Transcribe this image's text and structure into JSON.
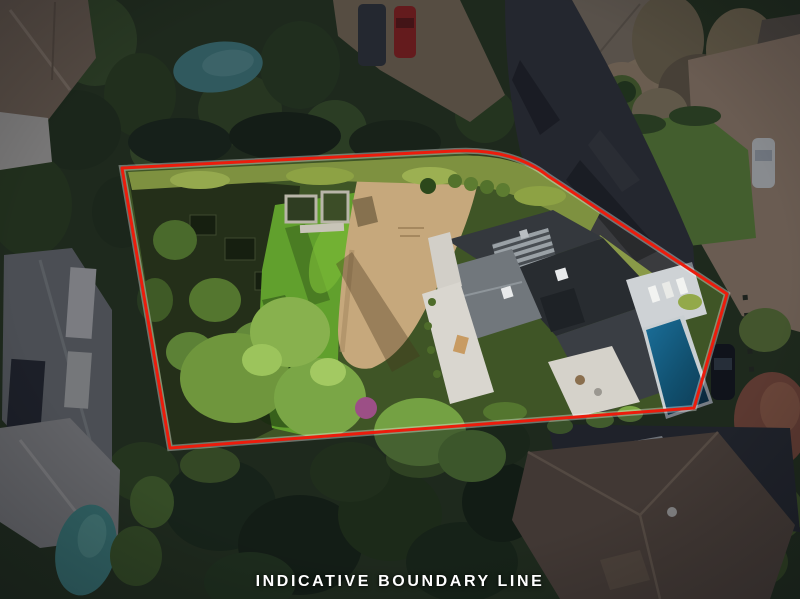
{
  "caption": {
    "text": "INDICATIVE BOUNDARY LINE",
    "color": "#ffffff"
  },
  "boundary": {
    "color": "#ec1c0c",
    "casing_color": "#ffffff"
  },
  "scene": {
    "type": "aerial-drone-photo",
    "features": [
      "subject-lot-boundary",
      "modern-house-dark-roof",
      "ribbed-roof-section",
      "white-decks",
      "swimming-pool",
      "pool-terrace",
      "lawn",
      "dead-grass-patch",
      "asphalt-driveway",
      "garden-terraces",
      "raised-planter-beds",
      "hedge-row",
      "neighbor-house-top",
      "neighbor-house-right-roof",
      "neighbor-house-bottom-right",
      "neighbor-house-left",
      "neighbor-house-bottom-left",
      "neighbor-pool-top-left",
      "neighbor-pool-bottom-left",
      "red-car",
      "dark-van",
      "white-car",
      "black-car",
      "boat",
      "autumn-tree",
      "tan-driveway-right",
      "dense-trees"
    ],
    "palette": {
      "lawn": "#61a02d",
      "dirt": "#c6a87c",
      "asphalt": "#3a3b3e",
      "roof_dark": "#2e3236",
      "deck_white": "#d9d6cf",
      "pool_subject_deep": "#0d3a52",
      "pool_subject_light": "#1a6e99",
      "pool_neighbor": "#4f9290",
      "tree_dark": "#243018",
      "tree_bright": "#7aa646",
      "roof_neighbor_brown": "#6b5947",
      "drive_tan": "#b1977a"
    }
  }
}
